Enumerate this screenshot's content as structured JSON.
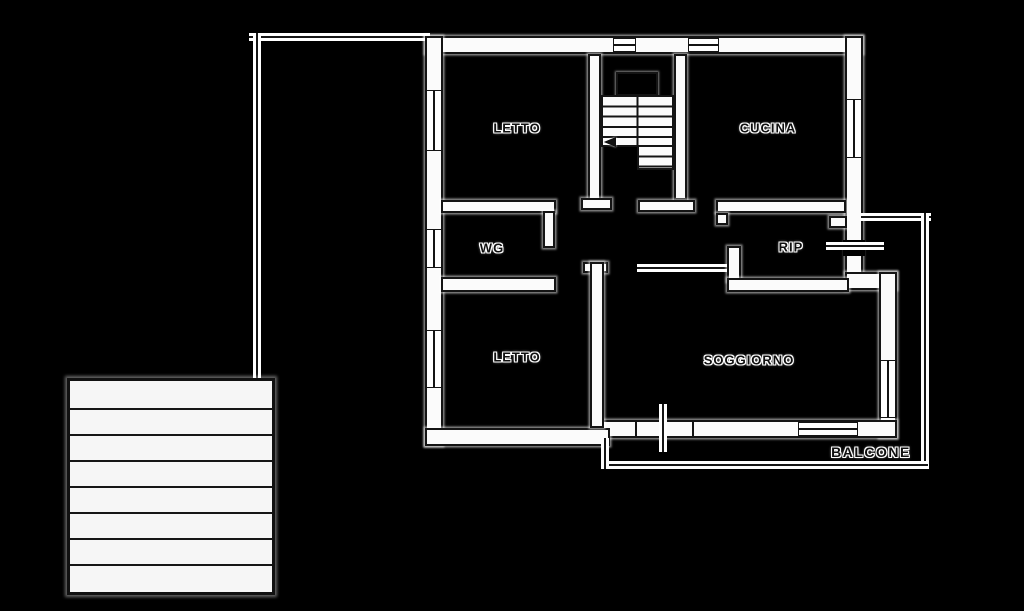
{
  "diagram_type": "apartment floor plan",
  "rooms": [
    {
      "name": "letto-1",
      "label": "LETTO"
    },
    {
      "name": "cucina",
      "label": "CUCINA"
    },
    {
      "name": "wg",
      "label": "WG"
    },
    {
      "name": "rip",
      "label": "RIP"
    },
    {
      "name": "letto-2",
      "label": "LETTO"
    },
    {
      "name": "soggiorno",
      "label": "SOGGIORNO"
    },
    {
      "name": "balcone",
      "label": "BALCONE"
    }
  ],
  "features": {
    "interior_staircase": "staircase with landing and down-left direction arrow",
    "exterior_staircase": "detached stair/ramp block, 7 treads",
    "balcony_outline": "thin line wrapping right and bottom of soggiorno",
    "boundary_line": "thin line from building top-left corner to exterior staircase"
  },
  "colors": {
    "background": "#000000",
    "wall_fill": "#fbfbfb",
    "line": "#141414",
    "text": "#101010",
    "text_halo": "#ffffff"
  }
}
